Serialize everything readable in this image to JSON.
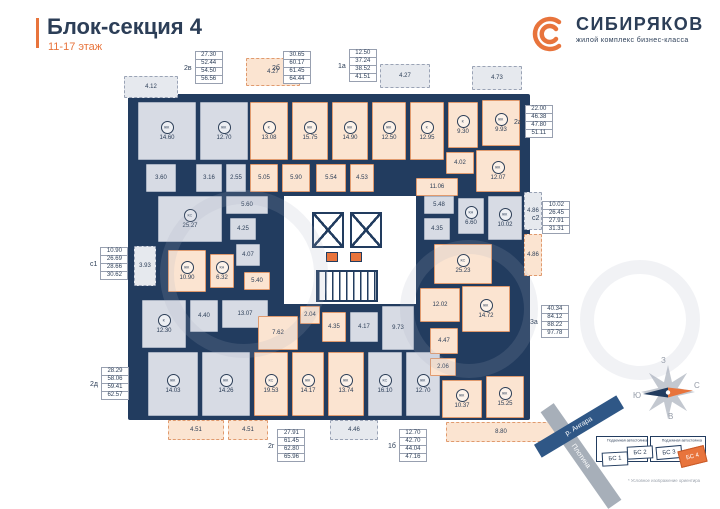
{
  "header": {
    "title": "Блок-секция 4",
    "subtitle": "11-17 этаж"
  },
  "brand": {
    "name": "СИБИРЯКОВ",
    "tagline": "жилой комплекс бизнес-класса"
  },
  "colors": {
    "navy": "#223c5f",
    "orange": "#e8743c",
    "peach_room": "#fbe4d1",
    "gray_room": "#d7dbe4"
  },
  "plan": {
    "room_codes_legend": [
      "ЖК",
      "К",
      "КС",
      "КН"
    ],
    "rooms": [
      {
        "code": "",
        "area": "4.12",
        "type": "balcony-gray",
        "x": 124,
        "y": 76,
        "w": 54,
        "h": 22
      },
      {
        "code": "ЖК",
        "area": "14.60",
        "type": "gray",
        "x": 138,
        "y": 102,
        "w": 58,
        "h": 58
      },
      {
        "code": "ЖК",
        "area": "12.70",
        "type": "gray",
        "x": 200,
        "y": 102,
        "w": 48,
        "h": 58
      },
      {
        "code": "",
        "area": "3.60",
        "type": "gray",
        "x": 146,
        "y": 164,
        "w": 30,
        "h": 28
      },
      {
        "code": "",
        "area": "3.16",
        "type": "gray",
        "x": 196,
        "y": 164,
        "w": 26,
        "h": 28
      },
      {
        "code": "",
        "area": "2.55",
        "type": "gray",
        "x": 226,
        "y": 164,
        "w": 20,
        "h": 28
      },
      {
        "code": "",
        "area": "4.27",
        "type": "balcony-peach",
        "x": 246,
        "y": 58,
        "w": 54,
        "h": 28
      },
      {
        "code": "К",
        "area": "13.08",
        "type": "peach",
        "x": 250,
        "y": 102,
        "w": 38,
        "h": 58
      },
      {
        "code": "ЖК",
        "area": "15.75",
        "type": "peach",
        "x": 292,
        "y": 102,
        "w": 36,
        "h": 58
      },
      {
        "code": "ЖК",
        "area": "14.90",
        "type": "peach",
        "x": 332,
        "y": 102,
        "w": 36,
        "h": 58
      },
      {
        "code": "",
        "area": "5.05",
        "type": "peach",
        "x": 250,
        "y": 164,
        "w": 28,
        "h": 28
      },
      {
        "code": "",
        "area": "5.90",
        "type": "peach",
        "x": 282,
        "y": 164,
        "w": 28,
        "h": 28
      },
      {
        "code": "ЖК",
        "area": "12.50",
        "type": "peach",
        "x": 372,
        "y": 102,
        "w": 34,
        "h": 58
      },
      {
        "code": "К",
        "area": "12.95",
        "type": "peach",
        "x": 410,
        "y": 102,
        "w": 34,
        "h": 58
      },
      {
        "code": "",
        "area": "5.54",
        "type": "peach",
        "x": 316,
        "y": 164,
        "w": 30,
        "h": 28
      },
      {
        "code": "",
        "area": "4.53",
        "type": "peach",
        "x": 350,
        "y": 164,
        "w": 24,
        "h": 28
      },
      {
        "code": "",
        "area": "4.27",
        "type": "balcony-gray",
        "x": 380,
        "y": 64,
        "w": 50,
        "h": 24
      },
      {
        "code": "",
        "area": "4.73",
        "type": "balcony-gray",
        "x": 472,
        "y": 66,
        "w": 50,
        "h": 24
      },
      {
        "code": "К",
        "area": "9.30",
        "type": "peach",
        "x": 448,
        "y": 102,
        "w": 30,
        "h": 46
      },
      {
        "code": "ЖК",
        "area": "9.93",
        "type": "peach",
        "x": 482,
        "y": 100,
        "w": 38,
        "h": 46
      },
      {
        "code": "",
        "area": "4.02",
        "type": "peach",
        "x": 446,
        "y": 152,
        "w": 28,
        "h": 22
      },
      {
        "code": "ЖК",
        "area": "12.07",
        "type": "peach",
        "x": 476,
        "y": 150,
        "w": 44,
        "h": 42
      },
      {
        "code": "",
        "area": "11.06",
        "type": "peach",
        "x": 416,
        "y": 178,
        "w": 42,
        "h": 18
      },
      {
        "code": "",
        "area": "5.60",
        "type": "gray",
        "x": 226,
        "y": 196,
        "w": 42,
        "h": 18
      },
      {
        "code": "КС",
        "area": "25.27",
        "type": "gray",
        "x": 158,
        "y": 196,
        "w": 64,
        "h": 46
      },
      {
        "code": "",
        "area": "4.25",
        "type": "gray",
        "x": 230,
        "y": 218,
        "w": 26,
        "h": 22
      },
      {
        "code": "",
        "area": "4.07",
        "type": "gray",
        "x": 236,
        "y": 244,
        "w": 24,
        "h": 22
      },
      {
        "code": "",
        "area": "3.93",
        "type": "balcony-gray",
        "x": 134,
        "y": 246,
        "w": 22,
        "h": 40
      },
      {
        "code": "ЖК",
        "area": "10.90",
        "type": "peach",
        "x": 168,
        "y": 250,
        "w": 38,
        "h": 42
      },
      {
        "code": "КН",
        "area": "6.32",
        "type": "peach",
        "x": 210,
        "y": 254,
        "w": 24,
        "h": 34
      },
      {
        "code": "",
        "area": "5.40",
        "type": "peach",
        "x": 244,
        "y": 272,
        "w": 26,
        "h": 18
      },
      {
        "code": "К",
        "area": "12.30",
        "type": "gray",
        "x": 142,
        "y": 300,
        "w": 44,
        "h": 48
      },
      {
        "code": "",
        "area": "4.40",
        "type": "gray",
        "x": 190,
        "y": 300,
        "w": 28,
        "h": 32
      },
      {
        "code": "",
        "area": "13.07",
        "type": "gray",
        "x": 222,
        "y": 300,
        "w": 46,
        "h": 28
      },
      {
        "code": "ЖК",
        "area": "14.03",
        "type": "gray",
        "x": 148,
        "y": 352,
        "w": 50,
        "h": 64
      },
      {
        "code": "ЖК",
        "area": "14.26",
        "type": "gray",
        "x": 202,
        "y": 352,
        "w": 48,
        "h": 64
      },
      {
        "code": "",
        "area": "4.51",
        "type": "balcony-peach",
        "x": 168,
        "y": 420,
        "w": 56,
        "h": 20
      },
      {
        "code": "",
        "area": "4.51",
        "type": "balcony-peach",
        "x": 228,
        "y": 420,
        "w": 40,
        "h": 20
      },
      {
        "code": "",
        "area": "7.62",
        "type": "peach",
        "x": 258,
        "y": 316,
        "w": 40,
        "h": 34
      },
      {
        "code": "",
        "area": "2.04",
        "type": "peach",
        "x": 300,
        "y": 306,
        "w": 20,
        "h": 18
      },
      {
        "code": "",
        "area": "4.35",
        "type": "peach",
        "x": 322,
        "y": 312,
        "w": 24,
        "h": 30
      },
      {
        "code": "КС",
        "area": "19.53",
        "type": "peach",
        "x": 254,
        "y": 352,
        "w": 34,
        "h": 64
      },
      {
        "code": "ЖК",
        "area": "14.17",
        "type": "peach",
        "x": 292,
        "y": 352,
        "w": 32,
        "h": 64
      },
      {
        "code": "ЖК",
        "area": "13.74",
        "type": "peach",
        "x": 328,
        "y": 352,
        "w": 36,
        "h": 64
      },
      {
        "code": "",
        "area": "4.17",
        "type": "gray",
        "x": 350,
        "y": 312,
        "w": 28,
        "h": 30
      },
      {
        "code": "",
        "area": "9.73",
        "type": "gray",
        "x": 382,
        "y": 306,
        "w": 32,
        "h": 44
      },
      {
        "code": "КС",
        "area": "16.10",
        "type": "gray",
        "x": 368,
        "y": 352,
        "w": 34,
        "h": 64
      },
      {
        "code": "ЖК",
        "area": "12.70",
        "type": "gray",
        "x": 406,
        "y": 352,
        "w": 34,
        "h": 64
      },
      {
        "code": "",
        "area": "4.46",
        "type": "balcony-gray",
        "x": 330,
        "y": 420,
        "w": 48,
        "h": 20
      },
      {
        "code": "",
        "area": "12.02",
        "type": "peach",
        "x": 420,
        "y": 288,
        "w": 40,
        "h": 34
      },
      {
        "code": "ЖК",
        "area": "14.72",
        "type": "peach",
        "x": 462,
        "y": 286,
        "w": 48,
        "h": 46
      },
      {
        "code": "",
        "area": "4.47",
        "type": "peach",
        "x": 430,
        "y": 328,
        "w": 28,
        "h": 26
      },
      {
        "code": "",
        "area": "2.06",
        "type": "peach",
        "x": 430,
        "y": 358,
        "w": 26,
        "h": 18
      },
      {
        "code": "ЖК",
        "area": "10.37",
        "type": "peach",
        "x": 442,
        "y": 380,
        "w": 40,
        "h": 38
      },
      {
        "code": "ЖК",
        "area": "15.25",
        "type": "peach",
        "x": 486,
        "y": 376,
        "w": 38,
        "h": 42
      },
      {
        "code": "",
        "area": "8.80",
        "type": "balcony-peach",
        "x": 446,
        "y": 422,
        "w": 110,
        "h": 20
      },
      {
        "code": "",
        "area": "5.48",
        "type": "gray",
        "x": 424,
        "y": 196,
        "w": 30,
        "h": 18
      },
      {
        "code": "",
        "area": "4.35",
        "type": "gray",
        "x": 424,
        "y": 218,
        "w": 26,
        "h": 22
      },
      {
        "code": "КН",
        "area": "6.60",
        "type": "gray",
        "x": 458,
        "y": 198,
        "w": 26,
        "h": 36
      },
      {
        "code": "ЖК",
        "area": "10.02",
        "type": "gray",
        "x": 488,
        "y": 196,
        "w": 34,
        "h": 44
      },
      {
        "code": "",
        "area": "4.86",
        "type": "balcony-gray",
        "x": 524,
        "y": 192,
        "w": 18,
        "h": 38
      },
      {
        "code": "КС",
        "area": "25.23",
        "type": "peach",
        "x": 434,
        "y": 244,
        "w": 58,
        "h": 40
      },
      {
        "code": "",
        "area": "4.86",
        "type": "balcony-peach",
        "x": 524,
        "y": 234,
        "w": 18,
        "h": 42
      }
    ],
    "stacks": [
      {
        "label": "2в",
        "values": [
          "27.30",
          "52.44",
          "54.50",
          "56.56"
        ],
        "x": 184,
        "y": 52
      },
      {
        "label": "2б",
        "values": [
          "30.65",
          "60.17",
          "61.45",
          "64.44"
        ],
        "x": 272,
        "y": 52
      },
      {
        "label": "1а",
        "values": [
          "12.50",
          "37.24",
          "38.52",
          "41.51"
        ],
        "x": 338,
        "y": 50
      },
      {
        "label": "2а",
        "values": [
          "22.00",
          "46.38",
          "47.80",
          "51.11"
        ],
        "x": 514,
        "y": 106
      },
      {
        "label": "с2",
        "values": [
          "10.02",
          "26.45",
          "27.91",
          "31.31"
        ],
        "x": 532,
        "y": 202
      },
      {
        "label": "3а",
        "values": [
          "40.34",
          "84.12",
          "88.22",
          "97.78"
        ],
        "x": 530,
        "y": 306
      },
      {
        "label": "с1",
        "values": [
          "10.90",
          "26.69",
          "28.66",
          "30.62"
        ],
        "x": 90,
        "y": 248
      },
      {
        "label": "2д",
        "values": [
          "28.29",
          "58.06",
          "59.41",
          "62.57"
        ],
        "x": 90,
        "y": 368
      },
      {
        "label": "2г",
        "values": [
          "27.91",
          "61.45",
          "62.80",
          "65.96"
        ],
        "x": 268,
        "y": 430
      },
      {
        "label": "1б",
        "values": [
          "12.70",
          "42.70",
          "44.04",
          "47.16"
        ],
        "x": 388,
        "y": 430
      }
    ]
  },
  "compass": {
    "top": "З",
    "right": "С",
    "left": "Ю",
    "bottom": "В"
  },
  "site_plan": {
    "parking_left_label": "Подземная автостоянка",
    "parking_right_label": "Подземная автостоянка",
    "blocks": [
      "БС 1",
      "БС 2",
      "БС 3",
      "БС 4"
    ],
    "highlighted_block": "БС 4",
    "river_label": "р. Ангара",
    "dam_label": "Плотина",
    "footnote": "* Условное изображение ориентира"
  }
}
